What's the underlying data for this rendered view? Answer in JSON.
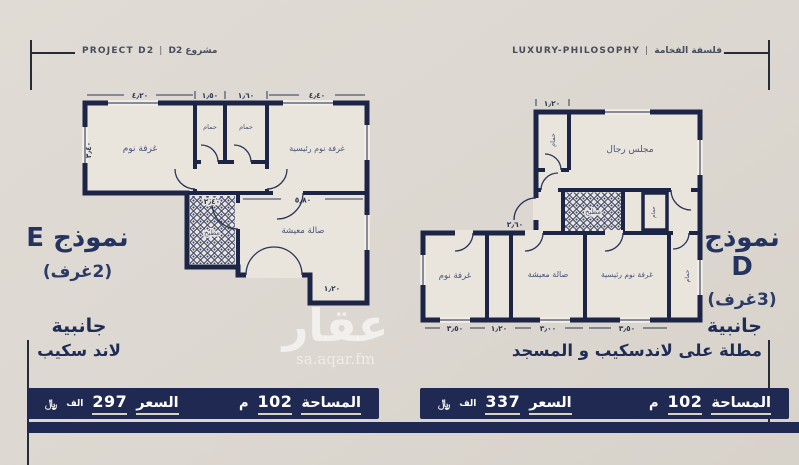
{
  "header": {
    "left_en": "PROJECT D2",
    "left_ar": "مشروع D2",
    "right_en": "LUXURY-PHILOSOPHY",
    "right_ar": "فلسفة الفخامة",
    "separator": "|"
  },
  "watermark": {
    "brand": "عقار",
    "site": "sa.aqar.fm"
  },
  "plan_e": {
    "model": "نموذج E",
    "rooms_count": "(2غرف)",
    "orientation": "جانبية",
    "view": "لاند سكيب",
    "labels": {
      "bedroom": "غرفة نوم",
      "bath1": "حمام",
      "bath2": "حمام",
      "master": "غرفة نوم رئيسية",
      "kitchen": "مطبخ",
      "living": "صالة معيشة"
    },
    "dims": {
      "bedroom": "٤٫٢٠",
      "bath1": "١٫٥٠",
      "bath2": "١٫٦٠",
      "master": "٤٫٤٠",
      "kitchen": "٢٫٤٠",
      "living": "٥٫٨٠",
      "entry": "١٫٢٠",
      "depth": "٣٫٤٠"
    },
    "stats": {
      "area_label": "المساحة",
      "area_value": "102",
      "area_unit": "م",
      "price_label": "السعر",
      "price_value": "297",
      "price_unit": "الف",
      "currency": "﷼"
    }
  },
  "plan_d": {
    "model": "نموذج D",
    "rooms_count": "(3غرف)",
    "orientation": "جانبية",
    "view": "مطلة على لاندسكيب و المسجد",
    "labels": {
      "majlis": "مجلس رجال",
      "bath_top": "حمام",
      "kitchen": "مطبخ",
      "bath_mid": "حمام",
      "bedroom": "غرفة نوم",
      "living": "صالة معيشة",
      "master": "غرفة نوم رئيسية",
      "bath_right": "حمام"
    },
    "dims": {
      "bath_top": "١٫٢٠",
      "kitchen": "٢٫٦٠",
      "bedroom": "٣٫٥٠",
      "corridor": "١٫٢٠",
      "living": "٣٫٠٠",
      "master": "٣٫٥٠"
    },
    "stats": {
      "area_label": "المساحة",
      "area_value": "102",
      "area_unit": "م",
      "price_label": "السعر",
      "price_value": "337",
      "price_unit": "الف",
      "currency": "﷼"
    }
  },
  "colors": {
    "navy": "#1d2546",
    "bar": "#1f2951",
    "cream": "#dcd7d0"
  }
}
